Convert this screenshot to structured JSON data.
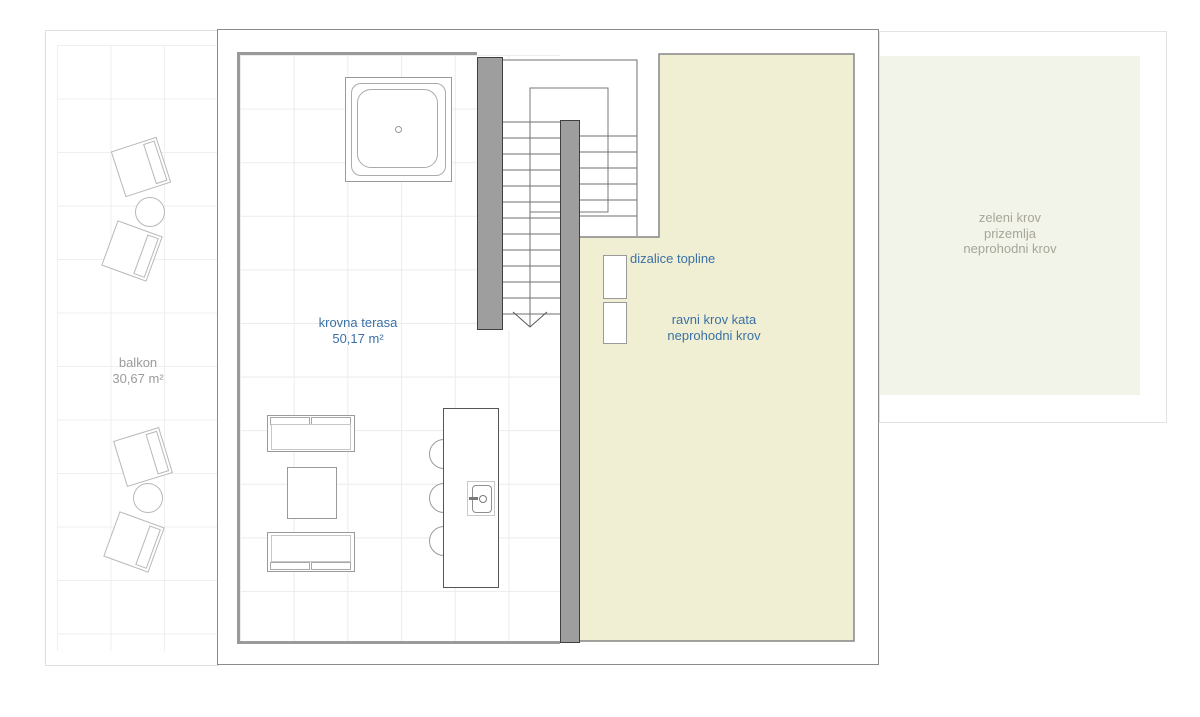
{
  "colors": {
    "label_blue": "#3b71a5",
    "label_gray": "#9b9b9b",
    "label_green_gray": "#a6a598",
    "roof_yellow": "#f1efd3",
    "roof_green": "#f3f4e9",
    "wall_gray": "#9e9e9e",
    "outline_gray": "#8a8a8a"
  },
  "areas": {
    "balkon": {
      "name": "balkon",
      "area": "30,67 m²"
    },
    "krovna_terasa": {
      "name": "krovna terasa",
      "area": "50,17 m²"
    },
    "dizalice_topline": {
      "label": "dizalice topline"
    },
    "ravni_krov_kata": {
      "line1": "ravni krov kata",
      "line2": "neprohodni krov"
    },
    "zeleni_krov": {
      "line1": "zeleni krov",
      "line2": "prizemlja",
      "line3": "neprohodni krov"
    }
  }
}
